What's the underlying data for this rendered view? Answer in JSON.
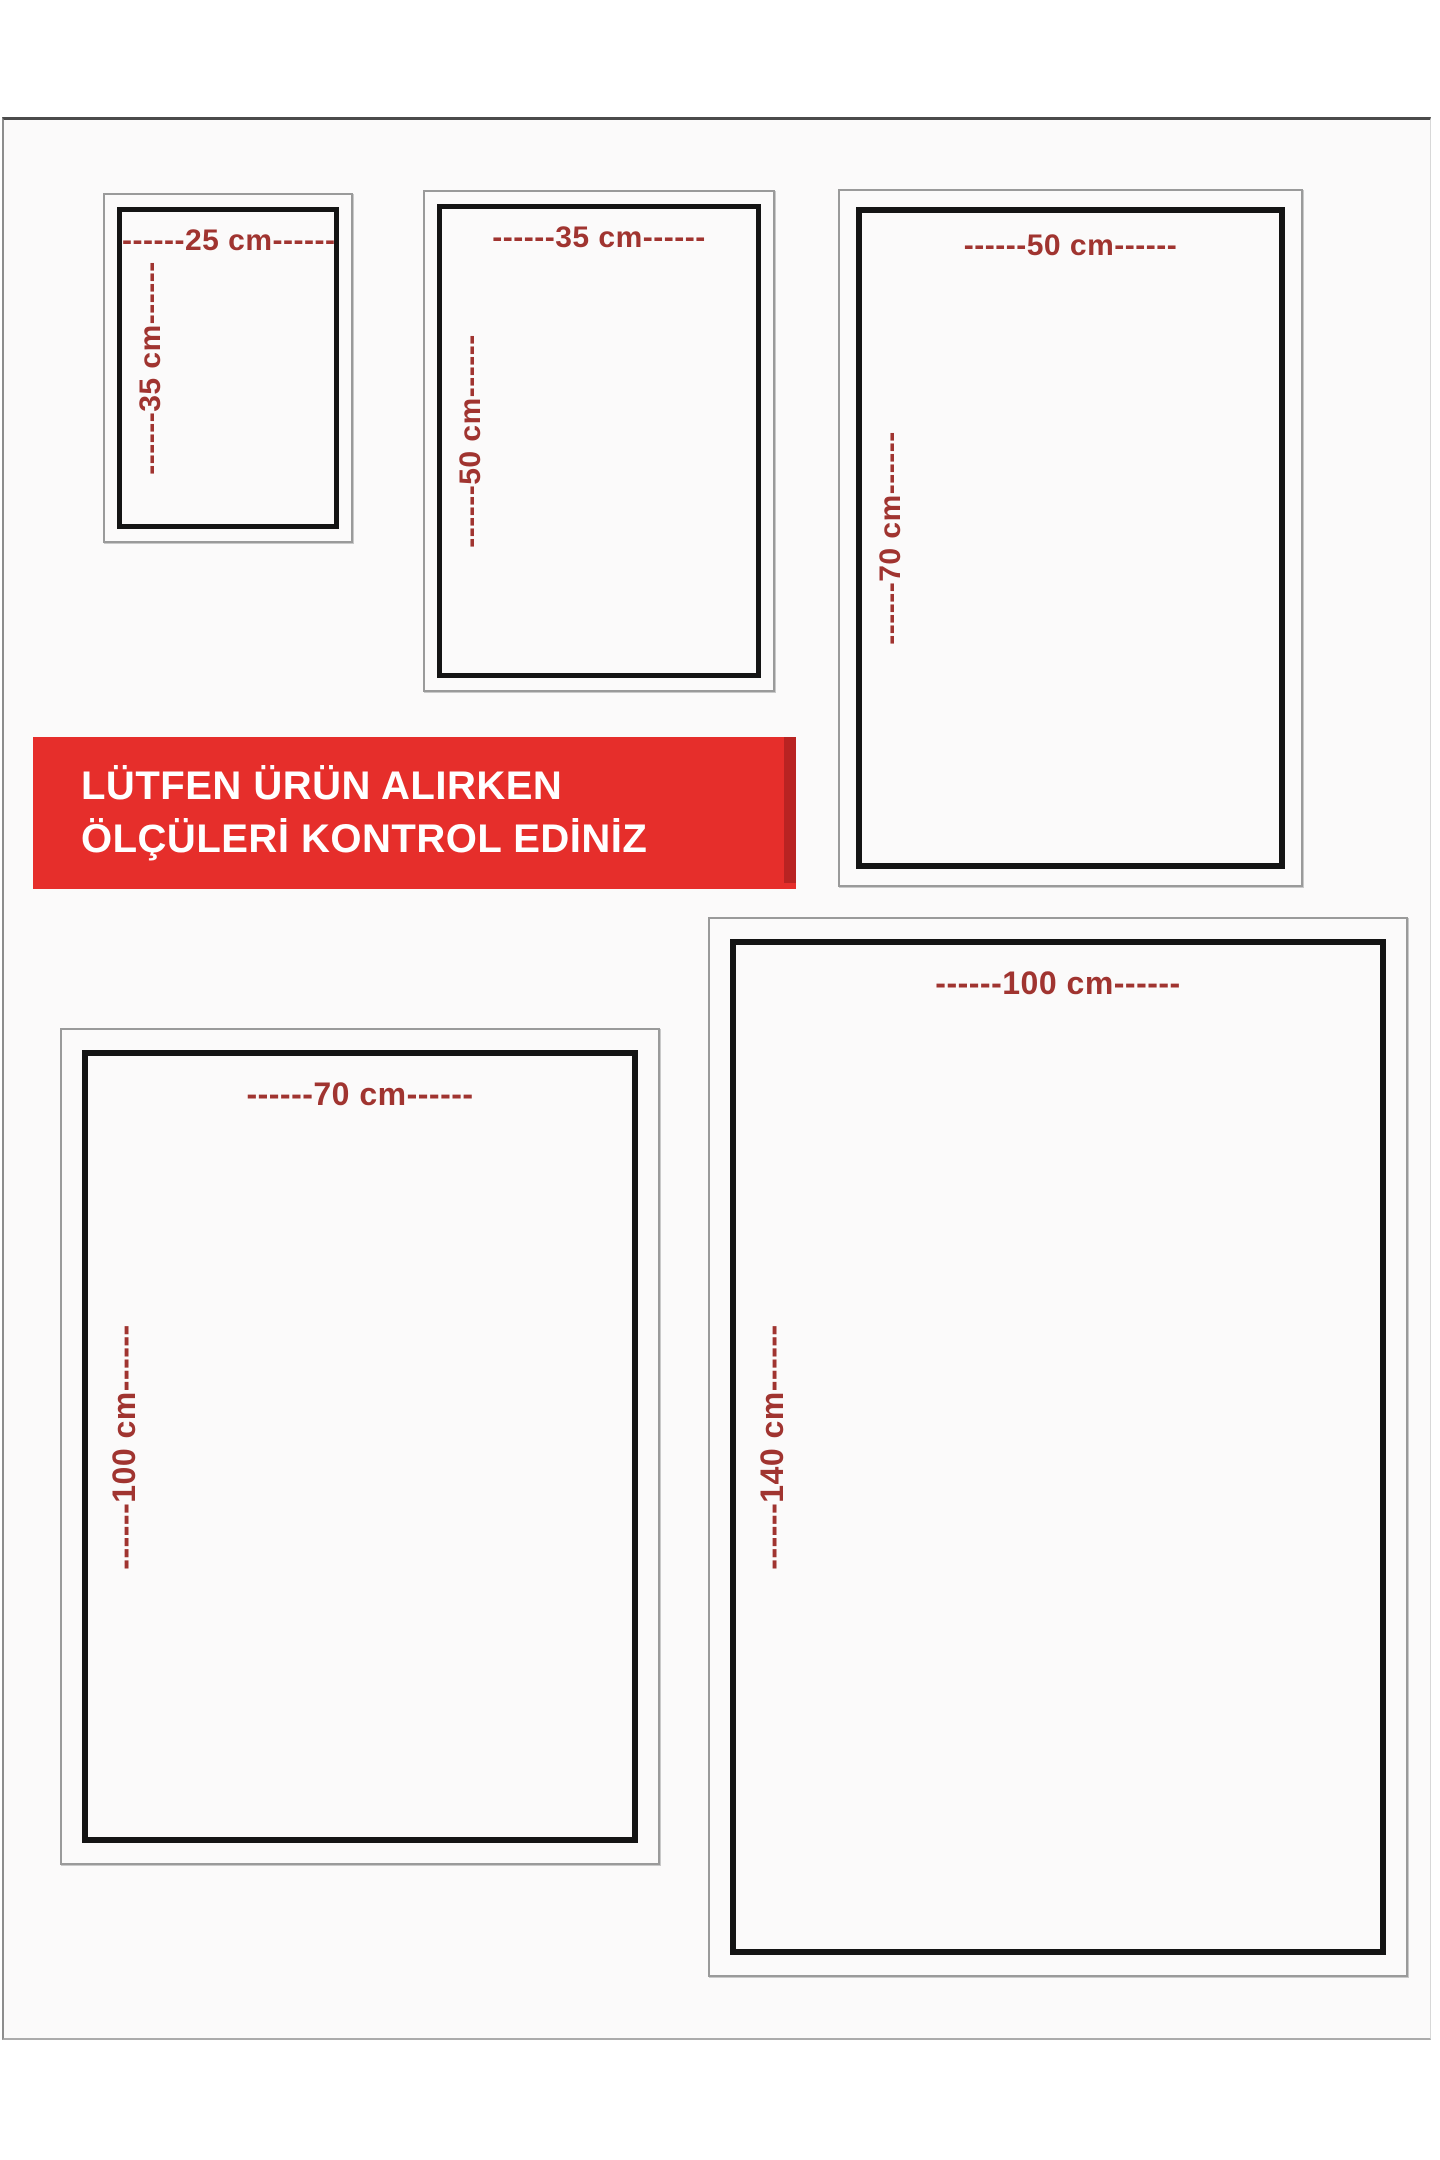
{
  "banner": {
    "line1": "LÜTFEN ÜRÜN ALIRKEN",
    "line2": "ÖLÇÜLERİ KONTROL EDİNİZ"
  },
  "boxes": [
    {
      "name": "25x35",
      "width_cm": 25,
      "height_cm": 35,
      "width_label": "------25 cm------",
      "height_label": "------35 cm------"
    },
    {
      "name": "35x50",
      "width_cm": 35,
      "height_cm": 50,
      "width_label": "------35 cm------",
      "height_label": "------50 cm------"
    },
    {
      "name": "50x70",
      "width_cm": 50,
      "height_cm": 70,
      "width_label": "------50 cm------",
      "height_label": "------70 cm------"
    },
    {
      "name": "70x100",
      "width_cm": 70,
      "height_cm": 100,
      "width_label": "------70 cm------",
      "height_label": "------100 cm------"
    },
    {
      "name": "100x140",
      "width_cm": 100,
      "height_cm": 140,
      "width_label": "------100 cm------",
      "height_label": "------140 cm------"
    }
  ],
  "colors": {
    "banner-bg": "#e62e2b",
    "banner-edge": "#b92322",
    "dim-red": "#a03430",
    "frame-black": "#141414",
    "outer-gray": "#9a9a9a",
    "page-bg": "#fbfafa",
    "page-top-line": "#4b4b4b"
  }
}
